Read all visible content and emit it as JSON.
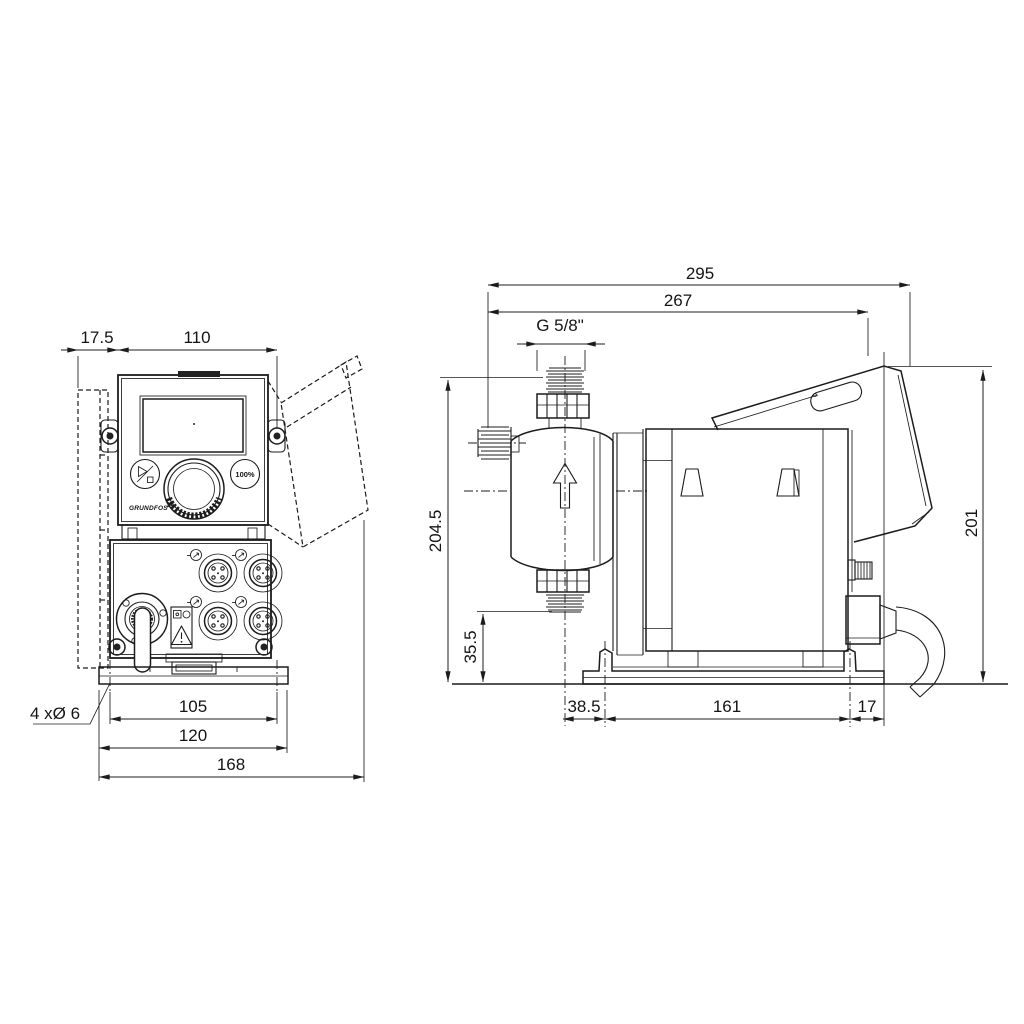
{
  "document": {
    "type": "technical-dimensional-drawing",
    "product": "dosing pump two-view outline drawing",
    "line_color": "#1c1c1c",
    "background": "#ffffff"
  },
  "front_view": {
    "dims": {
      "offset": "17.5",
      "width": "110",
      "hole_spacing": "105",
      "plate_width": "120",
      "total_width": "168",
      "hole_note": "4 xØ 6"
    },
    "panel": {
      "percent_button": "100%",
      "brand": "GRUNDFOS"
    }
  },
  "side_view": {
    "dims": {
      "total_depth": "295",
      "body_depth": "267",
      "thread": "G 5/8\"",
      "height_head": "204.5",
      "height_outlet": "35.5",
      "head_offset": "38.5",
      "hole_spacing": "161",
      "rear_offset": "17",
      "height_rear": "201"
    }
  }
}
